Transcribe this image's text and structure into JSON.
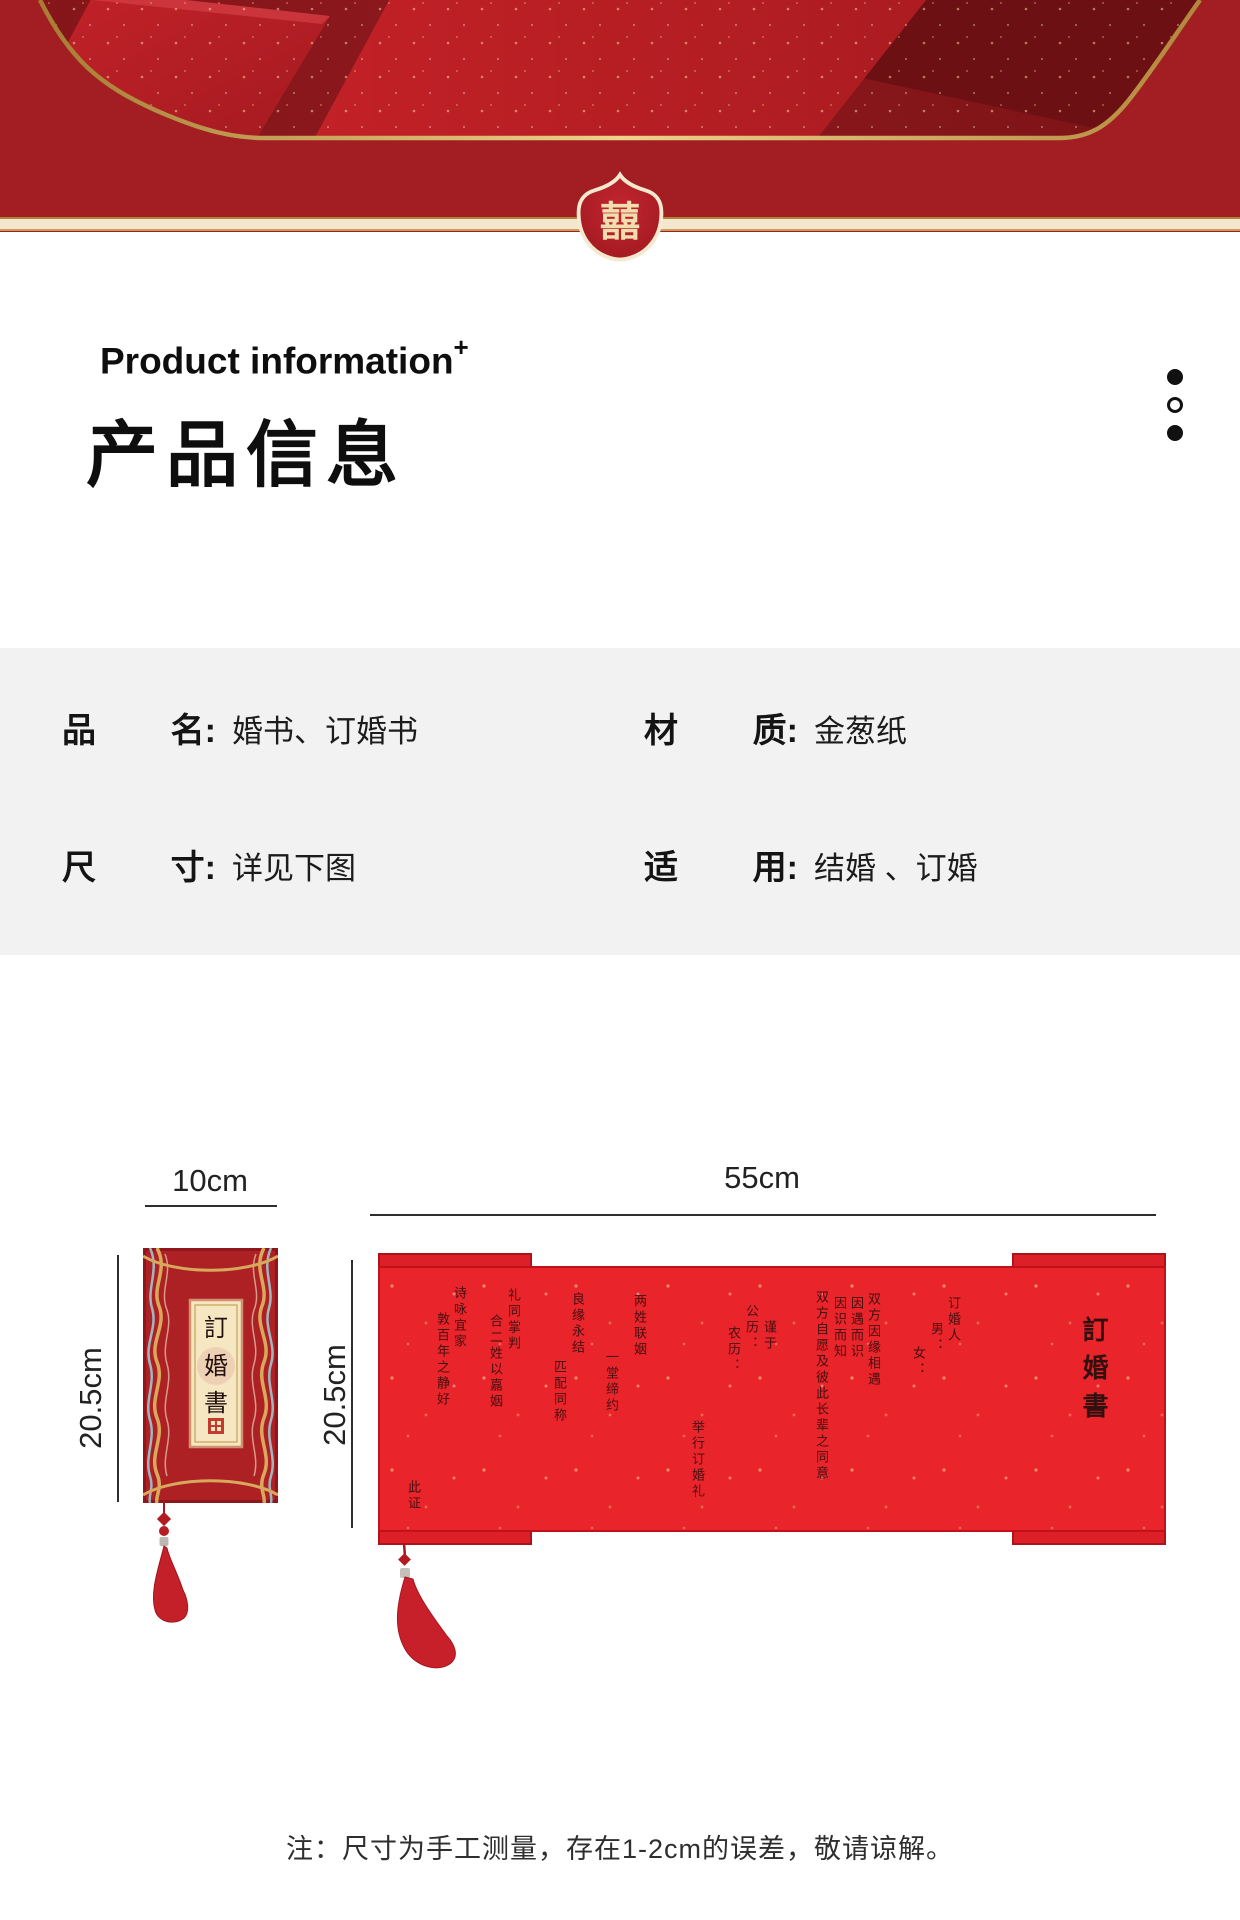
{
  "banner": {
    "badge": "囍"
  },
  "heading": {
    "en": "Product information",
    "plus": "+",
    "zh": "产品信息"
  },
  "specs": {
    "items": [
      {
        "k1": "品",
        "k2": "名:",
        "v": "婚书、订婚书"
      },
      {
        "k1": "材",
        "k2": "质:",
        "v": "金葱纸"
      },
      {
        "k1": "尺",
        "k2": "寸:",
        "v": "详见下图"
      },
      {
        "k1": "适",
        "k2": "用:",
        "v": "结婚 、订婚"
      }
    ]
  },
  "diagram": {
    "cover": {
      "width_label": "10cm",
      "height_label": "20.5cm",
      "title_chars": [
        "訂",
        "婚",
        "書"
      ]
    },
    "scroll": {
      "width_label": "55cm",
      "height_label": "20.5cm",
      "columns": [
        {
          "t": "訂婚書",
          "left": 700,
          "top": 48,
          "title": true
        },
        {
          "t": "订婚人",
          "left": 566,
          "top": 28
        },
        {
          "t": "男：",
          "left": 549,
          "top": 54
        },
        {
          "t": "女：",
          "left": 531,
          "top": 78
        },
        {
          "t": "双方因缘相遇",
          "left": 486,
          "top": 24
        },
        {
          "t": "因遇而识",
          "left": 469,
          "top": 28
        },
        {
          "t": "因识而知",
          "left": 452,
          "top": 28
        },
        {
          "t": "双方自愿及彼此长辈之同意",
          "left": 434,
          "top": 22
        },
        {
          "t": "谨于",
          "left": 382,
          "top": 52
        },
        {
          "t": "公历：",
          "left": 364,
          "top": 36
        },
        {
          "t": "农历：",
          "left": 346,
          "top": 58
        },
        {
          "t": "举行订婚礼",
          "left": 310,
          "top": 152
        },
        {
          "t": "两姓联姻",
          "left": 252,
          "top": 26
        },
        {
          "t": "一堂缔约",
          "left": 224,
          "top": 82
        },
        {
          "t": "良缘永结",
          "left": 190,
          "top": 24
        },
        {
          "t": "匹配同称",
          "left": 172,
          "top": 92
        },
        {
          "t": "礼同掌判",
          "left": 126,
          "top": 20
        },
        {
          "t": "合二姓以嘉姻",
          "left": 108,
          "top": 46
        },
        {
          "t": "诗咏宜家",
          "left": 72,
          "top": 18
        },
        {
          "t": "敦百年之静好",
          "left": 55,
          "top": 44
        },
        {
          "t": "此证",
          "left": 26,
          "top": 212
        }
      ]
    }
  },
  "note": "注：尺寸为手工测量，存在1-2cm的误差，敬请谅解。",
  "colors": {
    "page_red": "#a21e23",
    "photo_maroon": "#7d1316",
    "scroll_red": "#ea242b",
    "cover_red": "#ad2024",
    "gold": "#c9a254",
    "panel_gray": "#f2f2f2",
    "badge_red": "#b02026",
    "cream": "#f3e7cf"
  }
}
